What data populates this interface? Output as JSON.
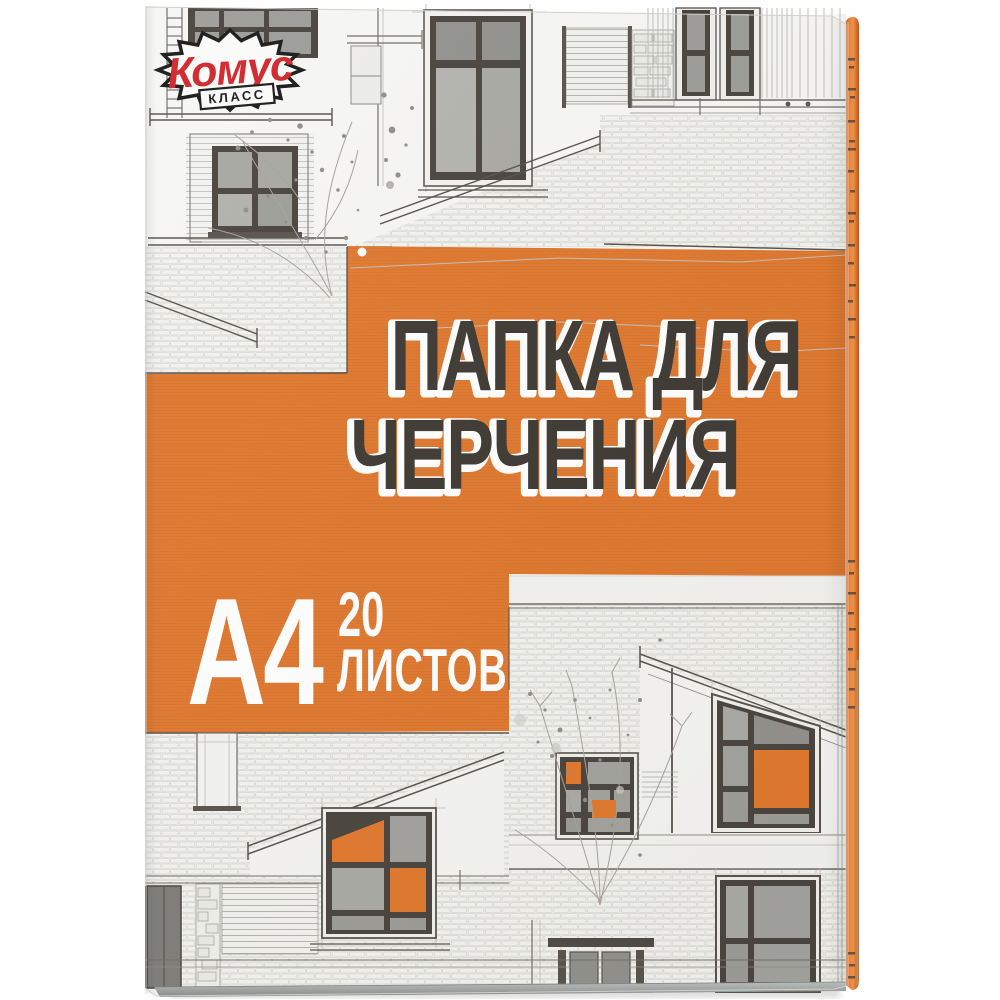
{
  "product": {
    "brand": "Комус",
    "brand_sub": "КЛАСС",
    "title_line1": "ПАПКА ДЛЯ",
    "title_line2": "ЧЕРЧЕНИЯ",
    "format": "А4",
    "sheet_count": "20",
    "sheet_word": "ЛИСТОВ"
  },
  "colors": {
    "accent_orange": "#e0762b",
    "brand_red": "#cf2127",
    "title_ink": "#3b362f",
    "sketch_line": "#6f6b64",
    "frame_dark": "#46413b",
    "pane_gray": "#a4a49f",
    "paper_white": "#f5f5f3"
  }
}
